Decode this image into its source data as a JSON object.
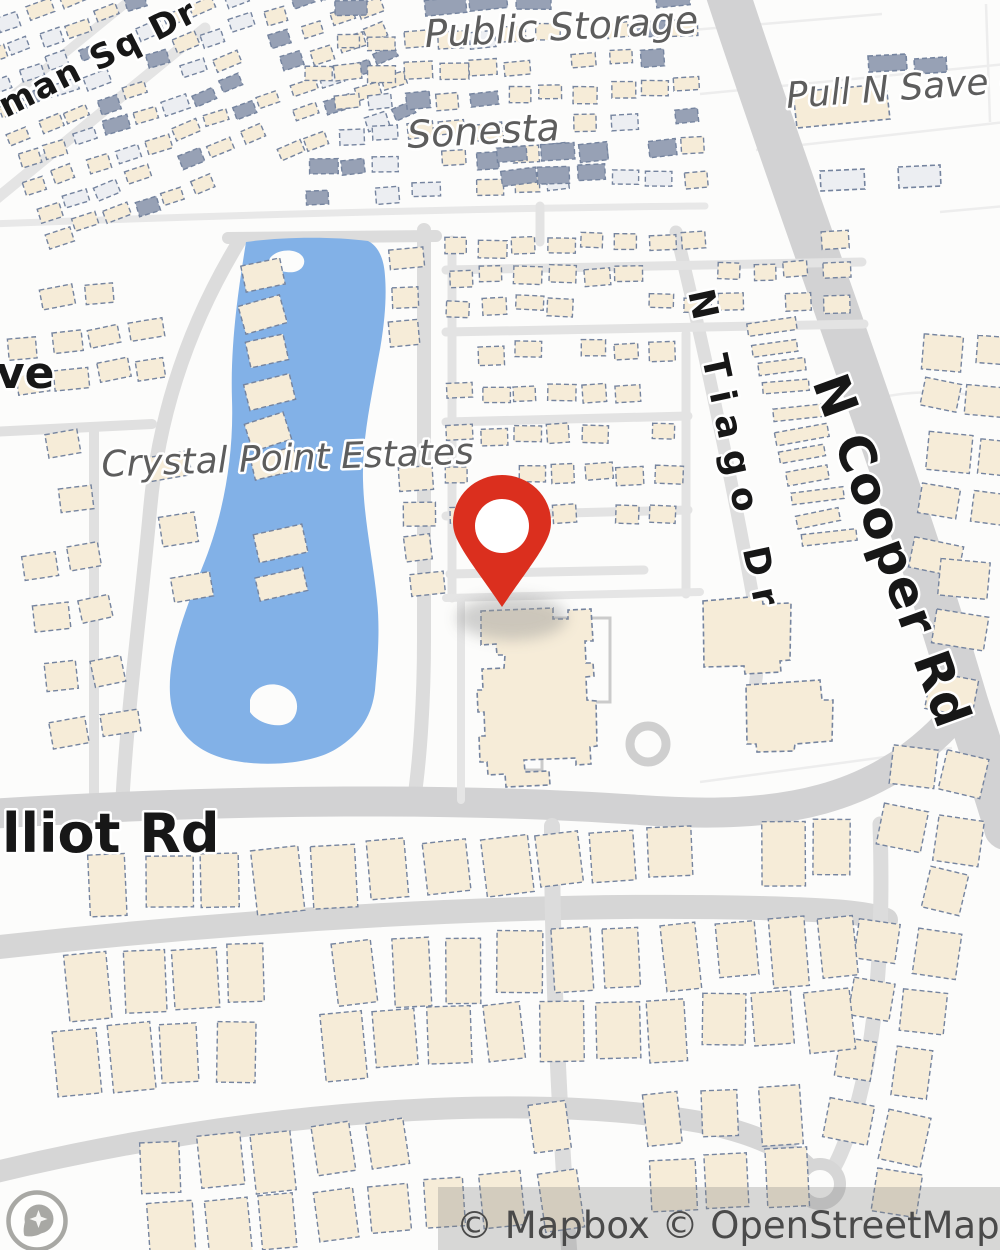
{
  "map": {
    "colors": {
      "background": "#fcfcfb",
      "road": "#dcdcdc",
      "road_major": "#d2d2d3",
      "road_light": "#e4e4e4",
      "lake": "#82b1e7",
      "building_fill": "#f6ecd8",
      "building_stroke": "#75849f",
      "building_slate": "#97a1b5",
      "building_pale": "#eceef2",
      "pin_red": "#db2f1e",
      "label_gray": "#5d5d5d",
      "label_black": "#171717",
      "attribution_text": "#4a4a4a",
      "logo_gray": "#a8a8a4"
    },
    "place_labels": [
      {
        "id": "public-storage",
        "text": "Public Storage"
      },
      {
        "id": "sonesta",
        "text": "Sonesta"
      },
      {
        "id": "pull-n-save",
        "text": "Pull N Save – U"
      },
      {
        "id": "crystal-point-estates",
        "text": "Crystal Point Estates"
      }
    ],
    "street_labels": [
      {
        "id": "man-sq-dr",
        "text": "man Sq Dr"
      },
      {
        "id": "ave-partial",
        "text": "ve"
      },
      {
        "id": "n-tiago-dr",
        "text": "N Tiago Dr"
      },
      {
        "id": "n-cooper-rd",
        "text": "N Cooper Rd"
      },
      {
        "id": "elliot-rd",
        "text": "lliot Rd"
      }
    ],
    "attribution": {
      "text": "© Mapbox © OpenStreetMap"
    },
    "logo": {
      "name": "mapbox-logo"
    },
    "pin": {
      "x": 502,
      "y": 524
    }
  },
  "geometry": {
    "roads": [
      {
        "d": "M-10,224 C200,216 480,208 705,206",
        "w": 7,
        "c": "#e8e8e8"
      },
      {
        "d": "M-15,208 L205,28",
        "w": 11,
        "c": "#e4e4e4"
      },
      {
        "d": "M-15,118 L125,4",
        "w": 9,
        "c": "#e4e4e4"
      },
      {
        "d": "M228,238 L436,236",
        "w": 12,
        "c": "#dcdcdc"
      },
      {
        "d": "M424,230 L424,640 C424,700 420,760 414,800",
        "w": 14,
        "c": "#dcdcdc"
      },
      {
        "d": "M240,240 C185,330 158,420 150,510 C142,600 128,700 122,806",
        "w": 14,
        "c": "#dcdcdc"
      },
      {
        "d": "M-10,432 L152,424",
        "w": 10,
        "c": "#e0e0e0"
      },
      {
        "d": "M94,428 L94,806",
        "w": 10,
        "c": "#e0e0e0"
      },
      {
        "d": "M726,-12 C795,200 898,470 966,702 C982,752 996,792 1006,828",
        "w": 44,
        "c": "#d2d2d3"
      },
      {
        "d": "M676,232 C700,330 730,470 752,592 C758,634 760,658 754,694",
        "w": 13,
        "c": "#dedede"
      },
      {
        "d": "M-12,814 C240,798 470,798 640,810 C780,820 880,804 960,710",
        "w": 30,
        "c": "#d2d2d3"
      },
      {
        "d": "M446,270 L862,262",
        "w": 9,
        "c": "#e3e3e3"
      },
      {
        "d": "M446,332 L864,324",
        "w": 9,
        "c": "#e3e3e3"
      },
      {
        "d": "M446,422 L688,416",
        "w": 9,
        "c": "#e3e3e3"
      },
      {
        "d": "M446,516 L688,510",
        "w": 9,
        "c": "#e3e3e3"
      },
      {
        "d": "M450,574 L644,570",
        "w": 9,
        "c": "#e3e3e3"
      },
      {
        "d": "M452,240 L452,598",
        "w": 9,
        "c": "#e3e3e3"
      },
      {
        "d": "M686,334 L686,594",
        "w": 9,
        "c": "#e3e3e3"
      },
      {
        "d": "M540,206 L540,242",
        "w": 9,
        "c": "#e3e3e3"
      },
      {
        "d": "M461,598 L461,800",
        "w": 8,
        "c": "#e5e5e5"
      },
      {
        "d": "M446,598 L700,592",
        "w": 8,
        "c": "#e5e5e5"
      },
      {
        "d": "M-10,948 C240,920 520,902 760,908 C830,910 866,912 886,920",
        "w": 24,
        "c": "#d6d6d6"
      },
      {
        "d": "M552,826 C552,950 558,1100 570,1262",
        "w": 16,
        "c": "#dcdcdc"
      },
      {
        "d": "M880,824 C884,950 876,1060 846,1140 C838,1162 832,1172 822,1184",
        "w": 15,
        "c": "#dcdcdc"
      },
      {
        "d": "M-12,1174 C240,1112 520,1090 700,1122 C760,1134 798,1154 814,1176",
        "w": 22,
        "c": "#d6d6d6"
      }
    ],
    "parcels": [
      {
        "d": "M700,94 L1006,64"
      },
      {
        "d": "M756,150 L1006,122"
      },
      {
        "d": "M692,30 L882,14"
      },
      {
        "d": "M842,412 C890,386 950,390 1006,400"
      },
      {
        "d": "M700,782 L952,748"
      },
      {
        "d": "M986,4 L990,122"
      },
      {
        "d": "M940,212 L1006,206"
      }
    ],
    "lake": {
      "path": "M246,242 C240,280 230,340 232,400 C234,460 222,520 202,568 C182,618 168,658 170,694 C172,728 192,750 226,759 C262,768 312,764 336,749 C362,733 372,714 375,690 C378,658 380,628 377,600 C373,560 364,520 363,480 C362,440 371,400 378,360 C384,330 387,300 385,276 C384,258 378,246 368,241 C330,236 280,237 246,242 Z",
      "islands": [
        "M270,258 C276,250 292,248 300,254 C308,260 304,270 294,272 C282,274 266,266 270,258 Z",
        "M250,700 C254,686 272,680 286,688 C300,696 300,714 290,722 C278,730 256,722 250,712 Z"
      ]
    },
    "cul_de_sac": {
      "cx": 820,
      "cy": 1184,
      "r": 20
    },
    "roundabout": {
      "cx": 648,
      "cy": 744,
      "r": 18
    },
    "parking": [
      {
        "x": 514,
        "y": 620,
        "w": 28,
        "h": 150
      },
      {
        "x": 554,
        "y": 618,
        "w": 56,
        "h": 84
      }
    ],
    "buildings_explicit": [
      {
        "d": "M481,611 L553,608 L553,619 L568,619 L568,610 L591,609 L593,641 L585,641 L586,663 L593,663 L594,676 L586,677 L587,700 L596,701 L597,746 L590,747 L591,764 L576,765 L576,758 L524,760 L525,772 L549,771 L550,785 L506,787 L505,774 L488,775 L487,762 L480,762 L479,736 L485,736 L484,712 L478,712 L477,690 L483,690 L482,669 L504,668 L505,655 L497,655 L496,644 L481,645 Z",
        "fill": "beige"
      },
      {
        "d": "M703,601 L762,596 L763,604 L791,603 L790,660 L780,661 L781,672 L745,674 L744,666 L704,667 Z",
        "fill": "beige"
      },
      {
        "d": "M746,685 L820,680 L822,700 L833,700 L832,741 L795,744 L794,751 L757,752 L756,744 L747,744 Z",
        "fill": "beige"
      },
      {
        "d": "M793,92 L886,84 L890,119 L797,128 Z",
        "fill": "beige"
      },
      {
        "d": "M868,56 L906,54 L907,70 L869,72 Z",
        "fill": "slate"
      },
      {
        "d": "M914,59 L946,57 L947,72 L915,74 Z",
        "fill": "slate"
      },
      {
        "d": "M820,171 L864,169 L865,189 L821,191 Z",
        "fill": "pale"
      },
      {
        "d": "M898,167 L940,165 L941,186 L899,188 Z",
        "fill": "pale"
      }
    ],
    "clusters": [
      {
        "x": -30,
        "y": 30,
        "cols": 13,
        "rows": 9,
        "cw": 31,
        "ch": 27,
        "w": 23,
        "h": 13,
        "rot": -20,
        "fills": [
          "beige",
          "slate",
          "pale",
          "beige"
        ],
        "skip": 0.12
      },
      {
        "x": 300,
        "y": 40,
        "cols": 12,
        "rows": 6,
        "cw": 34,
        "ch": 30,
        "w": 25,
        "h": 15,
        "rot": -3,
        "fills": [
          "beige",
          "pale",
          "slate",
          "beige",
          "beige"
        ],
        "skip": 0.15
      },
      {
        "x": 332,
        "y": 0,
        "cols": 8,
        "rows": 1,
        "cw": 46,
        "ch": 20,
        "w": 36,
        "h": 15,
        "rot": -2,
        "fills": [
          "slate"
        ],
        "skip": 0.2
      },
      {
        "x": 498,
        "y": 148,
        "cols": 3,
        "rows": 2,
        "cw": 40,
        "ch": 26,
        "w": 31,
        "h": 16,
        "rot": -4,
        "fills": [
          "slate"
        ],
        "skip": 0
      },
      {
        "x": 446,
        "y": 238,
        "cols": 12,
        "rows": 3,
        "cw": 34,
        "ch": 31,
        "w": 25,
        "h": 16,
        "rot": -1,
        "fills": [
          "beige"
        ],
        "skip": 0.18
      },
      {
        "x": 446,
        "y": 345,
        "cols": 7,
        "rows": 5,
        "cw": 34,
        "ch": 41,
        "w": 25,
        "h": 17,
        "rot": -1,
        "fills": [
          "beige"
        ],
        "skip": 0.22
      },
      {
        "x": 742,
        "y": 300,
        "cols": 1,
        "rows": 12,
        "cw": 0,
        "ch": 22,
        "w": 48,
        "h": 13,
        "rot": -8,
        "rowdx": 2.5,
        "fills": [
          "beige"
        ],
        "skip": 0.1
      },
      {
        "x": 386,
        "y": 252,
        "cols": 1,
        "rows": 10,
        "cw": 0,
        "ch": 36,
        "w": 30,
        "h": 22,
        "rot": -4,
        "fills": [
          "beige"
        ],
        "skip": 0.1
      },
      {
        "x": 238,
        "y": 268,
        "cols": 1,
        "rows": 9,
        "cw": 0,
        "ch": 38,
        "w": 44,
        "h": 27,
        "rot": -14,
        "rowdx": -7,
        "fills": [
          "beige"
        ],
        "skip": 0.1
      },
      {
        "x": 2,
        "y": 298,
        "cols": 4,
        "rows": 3,
        "cw": 41,
        "ch": 40,
        "w": 31,
        "h": 21,
        "rot": -8,
        "fills": [
          "beige"
        ],
        "skip": 0.15
      },
      {
        "x": 2,
        "y": 442,
        "cols": 2,
        "rows": 6,
        "cw": 46,
        "ch": 57,
        "w": 35,
        "h": 25,
        "rot": -10,
        "fills": [
          "beige"
        ],
        "skip": 0.2
      },
      {
        "x": 142,
        "y": 458,
        "cols": 1,
        "rows": 3,
        "cw": 0,
        "ch": 62,
        "w": 42,
        "h": 27,
        "rot": -12,
        "fills": [
          "beige"
        ],
        "skip": 0
      },
      {
        "x": 928,
        "y": 330,
        "cols": 2,
        "rows": 2,
        "cw": 50,
        "ch": 48,
        "w": 42,
        "h": 32,
        "rot": 8,
        "fills": [
          "beige"
        ],
        "skip": 0.1
      },
      {
        "x": 930,
        "y": 430,
        "cols": 2,
        "rows": 3,
        "cw": 52,
        "ch": 56,
        "w": 44,
        "h": 34,
        "rot": 8,
        "fills": [
          "beige"
        ],
        "skip": 0.15
      },
      {
        "x": 945,
        "y": 555,
        "cols": 1,
        "rows": 3,
        "cw": 0,
        "ch": 58,
        "w": 48,
        "h": 36,
        "rot": 8,
        "fills": [
          "beige"
        ],
        "skip": 0
      },
      {
        "x": 893,
        "y": 742,
        "cols": 2,
        "rows": 8,
        "cw": 56,
        "ch": 60,
        "w": 42,
        "h": 44,
        "rot": 10,
        "fills": [
          "beige"
        ],
        "skip": 0.2
      },
      {
        "x": 88,
        "y": 858,
        "cols": 14,
        "rows": 1,
        "cw": 56,
        "ch": 60,
        "w": 42,
        "h": 58,
        "rot": -3,
        "fills": [
          "beige"
        ],
        "skip": 0.1
      },
      {
        "x": 66,
        "y": 956,
        "cols": 15,
        "rows": 1,
        "cw": 54,
        "ch": 64,
        "w": 40,
        "h": 62,
        "rot": -3,
        "fills": [
          "beige"
        ],
        "skip": 0.08
      },
      {
        "x": 52,
        "y": 1030,
        "cols": 15,
        "rows": 1,
        "cw": 54,
        "ch": 62,
        "w": 40,
        "h": 60,
        "rot": -3,
        "fills": [
          "beige"
        ],
        "skip": 0.1
      },
      {
        "x": 86,
        "y": 1146,
        "cols": 13,
        "rows": 2,
        "cw": 56,
        "ch": 64,
        "w": 40,
        "h": 52,
        "rot": -5,
        "fills": [
          "beige"
        ],
        "skip": 0.18
      }
    ]
  }
}
